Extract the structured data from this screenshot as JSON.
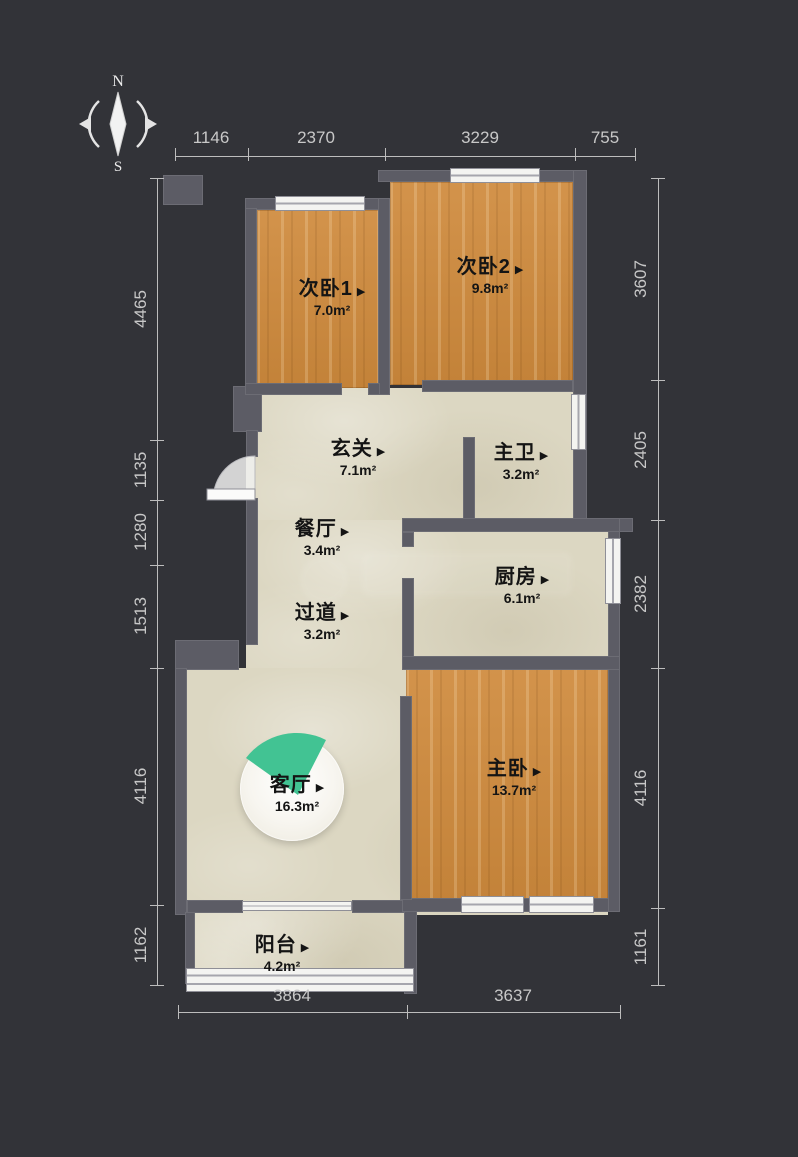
{
  "compass": {
    "north": "N",
    "south": "S"
  },
  "ui": {
    "room_arrow": "▶"
  },
  "rooms": [
    {
      "name": "次卧1",
      "area": "7.0m²",
      "type": "secondary-bedroom-1"
    },
    {
      "name": "次卧2",
      "area": "9.8m²",
      "type": "secondary-bedroom-2"
    },
    {
      "name": "玄关",
      "area": "7.1m²",
      "type": "entry-hall"
    },
    {
      "name": "主卫",
      "area": "3.2m²",
      "type": "master-bathroom"
    },
    {
      "name": "餐厅",
      "area": "3.4m²",
      "type": "dining-room"
    },
    {
      "name": "厨房",
      "area": "6.1m²",
      "type": "kitchen"
    },
    {
      "name": "过道",
      "area": "3.2m²",
      "type": "corridor"
    },
    {
      "name": "客厅",
      "area": "16.3m²",
      "type": "living-room"
    },
    {
      "name": "主卧",
      "area": "13.7m²",
      "type": "master-bedroom"
    },
    {
      "name": "阳台",
      "area": "4.2m²",
      "type": "balcony"
    }
  ],
  "dimensions": {
    "top": [
      "1146",
      "2370",
      "3229",
      "755"
    ],
    "left": [
      "4465",
      "1135",
      "1280",
      "1513",
      "4116",
      "1162"
    ],
    "right": [
      "3607",
      "2405",
      "2382",
      "4116",
      "1161"
    ],
    "bottom": [
      "3864",
      "3637"
    ]
  },
  "colors": {
    "background": "#323338",
    "wall": "#5c5c65",
    "wood_floor": "#cf8a3c",
    "tile_floor": "#dcd7c2",
    "camera_fan": "#42c393",
    "dimension_text": "#c8c8c8",
    "label_text": "#141414"
  }
}
